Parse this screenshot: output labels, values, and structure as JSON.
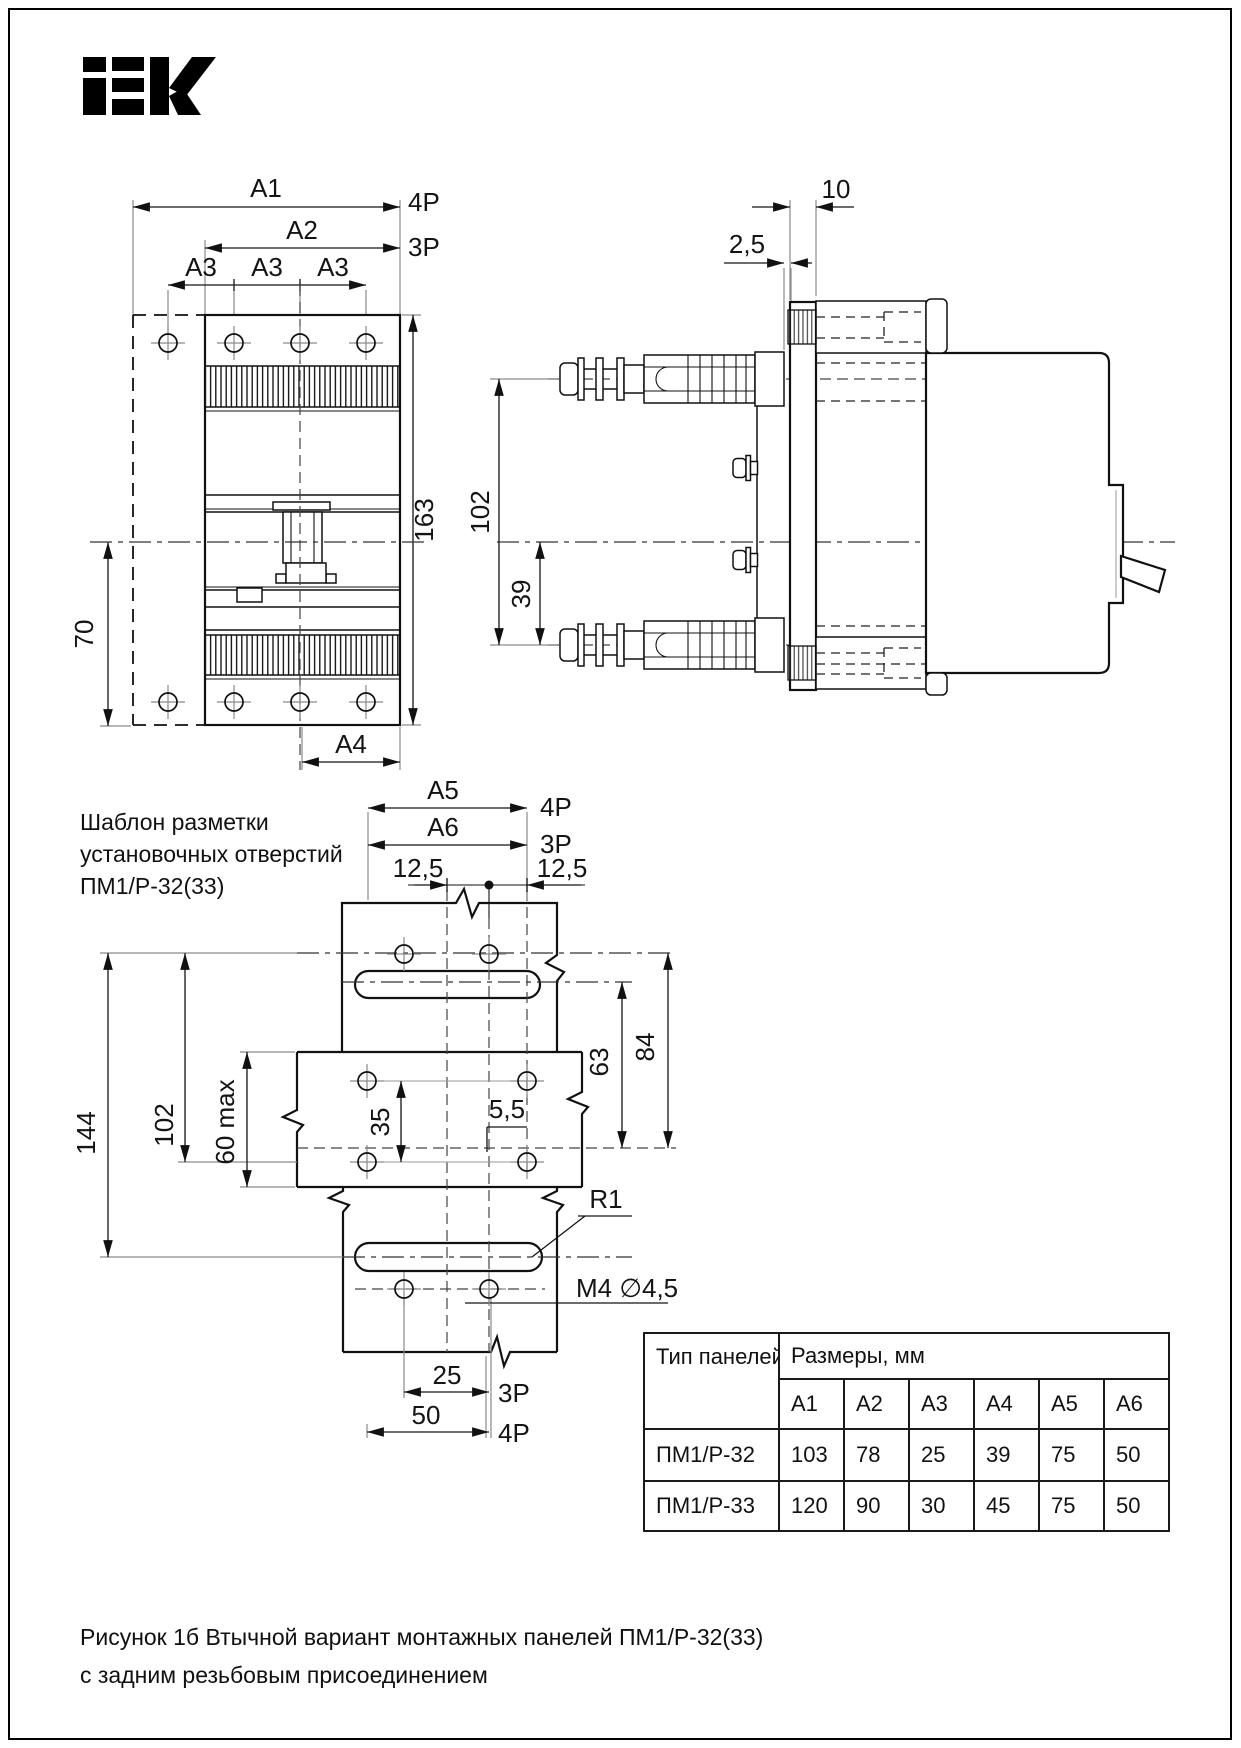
{
  "logo": {
    "brand": "IEK"
  },
  "front_view": {
    "a1": "A1",
    "a2": "A2",
    "a3": "A3",
    "p4": "4P",
    "p3": "3P",
    "h163": "163",
    "w70": "70",
    "a4": "A4"
  },
  "side_view": {
    "t10": "10",
    "t25": "2,5",
    "h102": "102",
    "h39": "39"
  },
  "template": {
    "label1": "Шаблон разметки",
    "label2": "установочных отверстий",
    "label3": "ПМ1/Р-32(33)",
    "a5": "A5",
    "p4": "4P",
    "a6": "A6",
    "p3": "3P",
    "l125": "12,5",
    "r125": "12,5",
    "v144": "144",
    "v102": "102",
    "v60": "60 max",
    "v35": "35",
    "d55": "5,5",
    "v63": "63",
    "v84": "84",
    "r1": "R1",
    "m4": "M4 ∅4,5",
    "d25": "25",
    "d50": "50",
    "p3b": "3P",
    "p4b": "4P"
  },
  "table": {
    "type_header": "Тип панелей",
    "sizes_header": "Размеры, мм",
    "dim_headers": [
      "А1",
      "А2",
      "А3",
      "А4",
      "А5",
      "А6"
    ],
    "rows": [
      {
        "type": "ПМ1/Р-32",
        "values": [
          "103",
          "78",
          "25",
          "39",
          "75",
          "50"
        ]
      },
      {
        "type": "ПМ1/Р-33",
        "values": [
          "120",
          "90",
          "30",
          "45",
          "75",
          "50"
        ]
      }
    ]
  },
  "caption": {
    "line1": "Рисунок 1б  Втычной вариант монтажных панелей ПМ1/Р-32(33)",
    "line2": "с задним резьбовым присоединением"
  }
}
